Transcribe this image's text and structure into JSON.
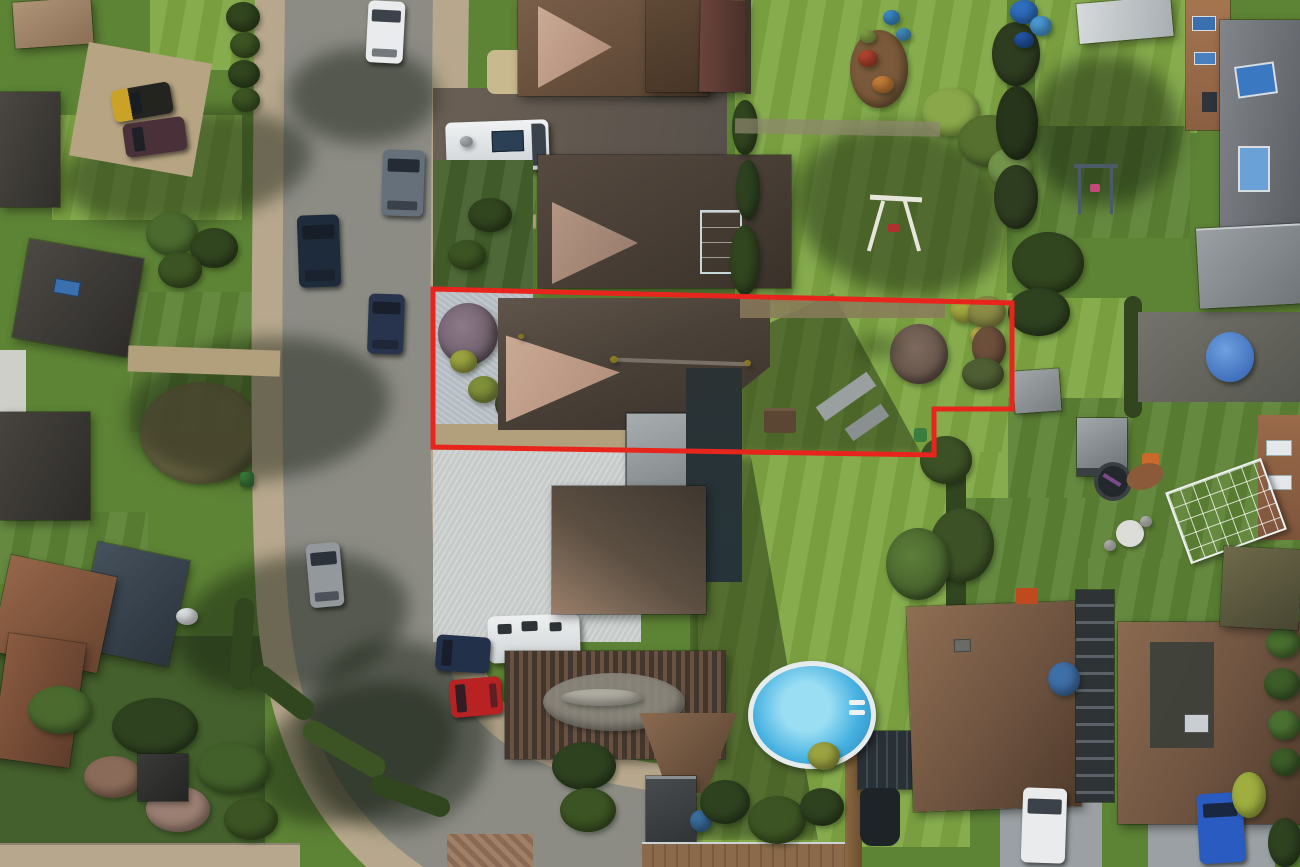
{
  "scene": {
    "type": "aerial-drone-photograph",
    "subject": "Aerial view of a residential street with a bungalow and long rear garden outlined by a red property boundary",
    "features": [
      "road",
      "pavements",
      "parked cars",
      "subject bungalow",
      "gravel driveway",
      "rear lawn",
      "garden trees",
      "neighbouring bungalows",
      "white motorhome",
      "white caravan",
      "swimming pool",
      "garden sheds",
      "greenhouses",
      "hedges",
      "decking",
      "red boundary outline"
    ]
  },
  "boundary": {
    "label": "property-boundary",
    "points": "433,289 1012,303 1012,409 934,409 934,455 433,447",
    "stroke_width": 5
  },
  "colors": {
    "red": "#e8251d",
    "roadGray": "#8c8c85",
    "pavement": "#b7a88d",
    "grassSun": "#7fa844",
    "grassMid": "#5d8335",
    "grassShade": "#44602c",
    "hedge": "#31451f",
    "gravelBlue": "#b4bcc2",
    "gravelLight": "#c6cbc9",
    "tan": "#b2a07c",
    "dirt": "#7a6a4e",
    "roofDark": "#4d433a",
    "roofBrown": "#7b5a44",
    "roofPink": "#c4a18c",
    "roofCharcoal": "#3a3733",
    "roofTerracotta": "#7e523c",
    "roofGray": "#75797e",
    "flatGray": "#9aa0a2",
    "maroon": "#5c3a33",
    "teal": "#3e7d86",
    "poolBlue": "#45b0e0",
    "poolDeep": "#2c7fb8",
    "poolRim": "#e6ecee",
    "white": "#e9ebec",
    "navy": "#22304a",
    "carBlue": "#2a5bc0",
    "carRed": "#b82222",
    "carSilver": "#93989d",
    "deck": "#8a6a4a",
    "purpleTree": "#7a6675",
    "bareTree": "#6d5a50"
  }
}
